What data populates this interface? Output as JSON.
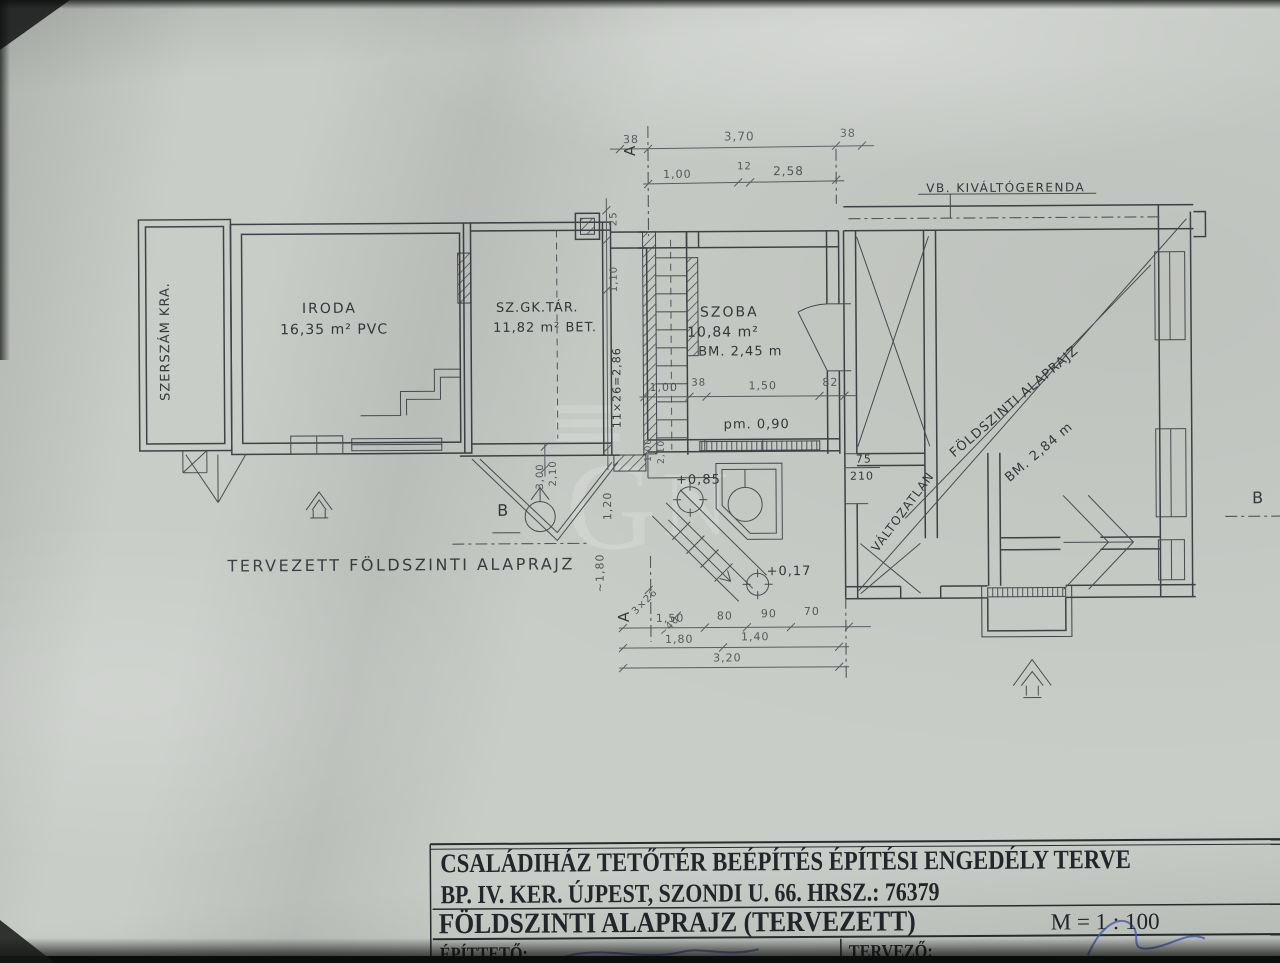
{
  "colors": {
    "paper": "#c9cdc8",
    "ink": "#3f4246",
    "pencil": "#55585a",
    "pen": "#4a5fb8"
  },
  "rooms": {
    "szerszam": {
      "label": "SZERSZÁM KRA."
    },
    "iroda": {
      "name": "IRODA",
      "area": "16,35 m² PVC"
    },
    "szgktar": {
      "name": "SZ.GK.TÁR.",
      "area": "11,82 m² BET."
    },
    "szoba": {
      "name": "SZOBA",
      "area": "10,84 m²",
      "height": "BM. 2,45 m"
    }
  },
  "annotations": {
    "plan_title": "TERVEZETT FÖLDSZINTI ALAPRAJZ",
    "beam": "VB. KIVÁLTÓGERENDA",
    "diag1": "FÖLDSZINTI ALAPRAJZ",
    "diag2": "BM. 2,84 m",
    "unchanged": "VÁLTOZATLAN",
    "sill": "pm. 0,90",
    "lvl_085": "+0,85",
    "lvl_017": "+0,17",
    "door_w": "75",
    "door_h": "210",
    "stair_main": "11×26=2,86",
    "stair_small": "3×26",
    "stair_small2": "~40",
    "sec_a": "A",
    "sec_b": "B"
  },
  "dims": {
    "top1": [
      "38",
      "3,70",
      "38"
    ],
    "top2": [
      "1,00",
      "12",
      "2,58"
    ],
    "left": [
      "25",
      "1,10"
    ],
    "mid": [
      "1,00",
      "38",
      "1,50",
      "82"
    ],
    "bottom1": [
      "1,50",
      "80",
      "90",
      "70"
    ],
    "bottom2": [
      "1,80",
      "1,40"
    ],
    "bottom3": "3,20",
    "v1": "3,00",
    "v2": "2,10",
    "v3": "1,20",
    "v4": "~1,80",
    "v5": "1,00",
    "v6": "2,10"
  },
  "titleblock": {
    "line1": "CSALÁDIHÁZ TETŐTÉR BEÉPÍTÉS ÉPÍTÉSI ENGEDÉLY TERVE",
    "line2": "BP. IV. KER. ÚJPEST, SZONDI U. 66. HRSZ.: 76379",
    "line3": "FÖLDSZINTI ALAPRAJZ (TERVEZETT)",
    "scale": "M = 1 : 100",
    "client": "ÉPÍTTETŐ:",
    "designer": "TERVEZŐ:"
  }
}
